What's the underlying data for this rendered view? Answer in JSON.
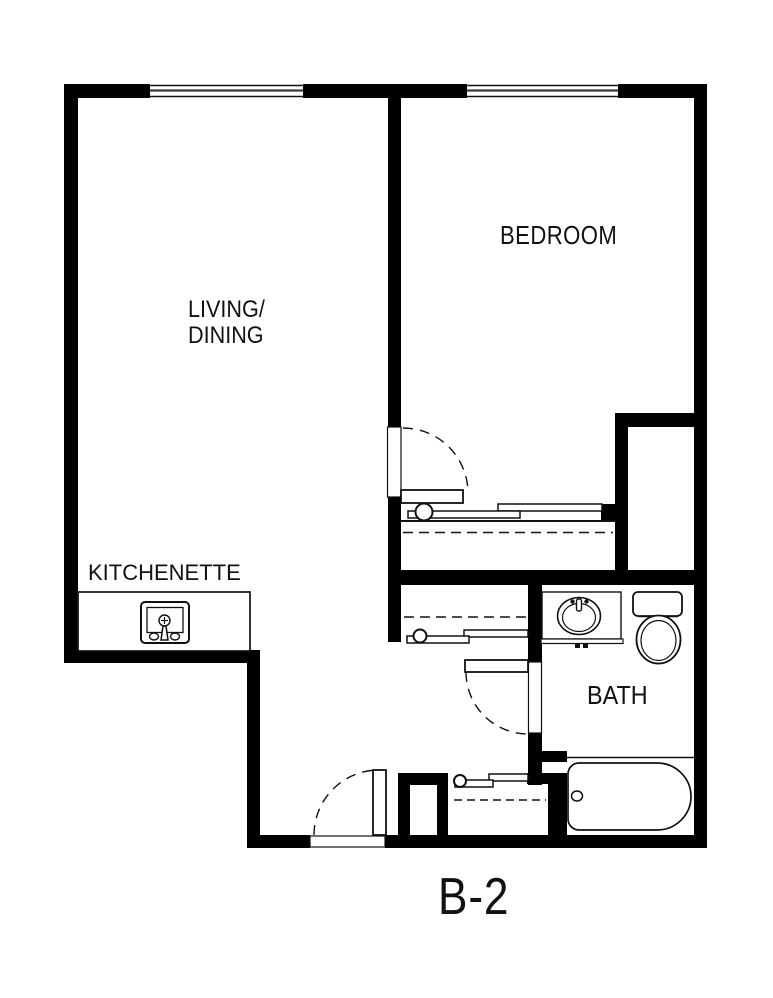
{
  "plan": {
    "unit_label": "B-2",
    "labels": {
      "bedroom": "BEDROOM",
      "living_line1": "LIVING/",
      "living_line2": "DINING",
      "kitchenette": "KITCHENETTE",
      "bath": "BATH"
    },
    "colors": {
      "walls": "#000000",
      "background": "#ffffff",
      "linework": "#111111"
    }
  }
}
